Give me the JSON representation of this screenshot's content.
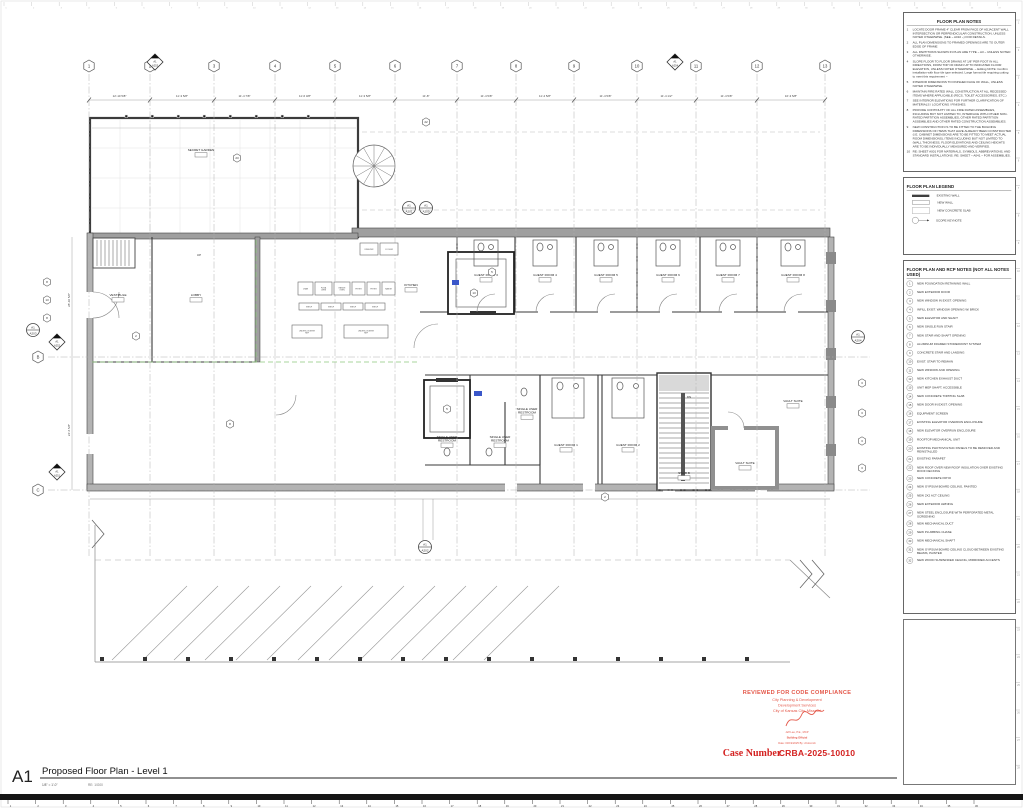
{
  "sheet": {
    "number": "A1",
    "title": "Proposed Floor Plan - Level 1",
    "scale": "1/8\" = 1'-0\"",
    "scale_ref": "RE: 1/G00"
  },
  "stamp": {
    "line1": "REVIEWED FOR CODE COMPLIANCE",
    "line2": "City Planning & Development",
    "line3": "Development Services",
    "line4": "City of Kansas City, Missouri",
    "signer": "Jeff Lee, P.E., MCP",
    "signer_title": "Building Official",
    "date_line": "Date: 03/19/2025    By: cholcomb",
    "case_label": "Case Number",
    "case_number": "CRBA-2025-10010"
  },
  "colors": {
    "stamp_red": "#e4584a",
    "case_red": "#d42221",
    "highlight_blue": "#3a57c9",
    "grid_gray": "#b0b0b0",
    "wall_dark": "#3c3c3c",
    "wall_gray": "#b3b3b3",
    "green_line": "#8fc97e"
  },
  "panels": {
    "notes": {
      "title": "FLOOR PLAN NOTES",
      "items": [
        "LOCATE DOOR FRAME 4\" CLEAR FROM FACE OF ADJACENT WALL INTERSECTION OR PERPENDICULAR CONSTRUCTION, UNLESS NOTED OTHERWISE. (SEE ~ A010 ~) FOR DETAILS.",
        "ALL PLAN DIMENSIONS TO FRAMED OPENINGS ARE TO OUTER EDGE OF FRAME",
        "ALL PARTITIONS SHOWN IN PLAN ARE TYPE ~ A3 ~ UNLESS NOTED OTHERWISE.",
        "SLOPE FLOOR TO FLOOR DRAINS AT 1/8\" PER FOOT IN ALL DIRECTIONS, FROM TOP OF DRAIN UP TO INDICATED FLOOR ELEVATION, UNLESS NOTED OTHERWISE. ~ Editing NOTE: Confirm installation with floor tile type selected. Large format tile requiring cutting to meet this requirement ~",
        "INTERIOR DIMENSIONS TO FINISHED FACE OF WALL, UNLESS NOTED OTHERWISE.",
        "MAINTAIN FIRE RATED WALL CONSTRUCTION AT ALL RECESSED ITEMS WHERE APPLICABLE (FECS, TOILET ACCESSORIES, ETC.)",
        "SEE INTERIOR ELEVATIONS FOR FURTHER CLARIFICATION OF MATERIALS / LOCATIONS / FINISHES.",
        "PROVIDE CONTINUITY OF ALL FIRE RATED ASSEMBLIES, INCLUDING BUT NOT LIMITED TO, INTERFACE WITH OTHER NON-RATED PARTITION ASSEMBLIES, OTHER RATED PARTITION ASSEMBLIES AND OTHER RATED CONSTRUCTION ASSEMBLIES.",
        "NEW CONSTRUCTION IS TO BE FITTED TO THE BUILDING DIMENSIONS OF ITEMS THAT HAVE ALREADY BEEN CONSTRUCTED (I.E. CABINET DIMENSIONS ARE TO BE FITTED TO MEET ACTUAL ROOM DIMENSIONS), ITEMS INCLUDING BUT NOT LIMITED TO (WALL THICKNESS, FLOOR ELEVATIONS AND CEILING HEIGHTS ARE TO BE INDIVIDUALLY MEASURED AND VERIFIED.",
        "RE: SHEET A001 FOR MATERIALS, SYMBOLS, ABBREVIATIONS, AND STANDARD INSTALLATIONS. RE: SHEET ~ A041 ~ FOR ASSEMBLIES."
      ]
    },
    "legend": {
      "title": "FLOOR PLAN LEGEND",
      "items": [
        {
          "symbol": "existing-wall",
          "label": "EXISTING WALL"
        },
        {
          "symbol": "new-wall",
          "label": "NEW WALL"
        },
        {
          "symbol": "new-concrete-slab",
          "label": "NEW CONCRETE SLAB"
        },
        {
          "symbol": "scope-keynote",
          "label": "SCOPE KEYNOTE"
        }
      ]
    },
    "refnotes": {
      "title": "FLOOR PLAN AND RCP NOTES (NOT ALL NOTES USED)",
      "items": [
        "NEW FOUNDATION RETAINING WALL",
        "NEW EXTERIOR DOOR",
        "NEW WINDOW IN EXIST. OPENING",
        "INFILL EXIST. WINDOW OPENING W/ BRICK",
        "NEW ELEVATOR AND SHAFT",
        "NEW SINGLE RUN STAIR",
        "NEW STAIR AND SHAFT OPENING",
        "ALUMINUM FRAMED STOREFRONT SYSTEM",
        "CONCRETE STAIR AND LANDING",
        "EXIST. STAIR TO REMAIN",
        "NEW WINDOW AND OPENING",
        "NEW KITCHEN EXHAUST DUCT",
        "UNIT MEP SHAFT, ACCESSIBLE",
        "NEW CONCRETE TOPPING SLAB",
        "NEW DOOR IN EXIST. OPENING",
        "EQUIPMENT SCREEN",
        "EXISTING ELEVATOR OVERRUN ENCLOSURE",
        "NEW ELEVATOR OVERRUN ENCLOSURE",
        "ROOFTOP MECHANICAL UNIT",
        "EXISTING PHOTOVOLTAIC PANELS TO BE REMOVED AND REINSTALLED",
        "EXISTING PARAPET",
        "NEW ROOF OVER NEW ROOF INSULATION OVER EXISTING ROOF DECKING",
        "NEW CONCRETE PATIO",
        "NEW GYPSUM BOARD CEILING, PAINTED",
        "NEW 2X2 ACT CEILING",
        "NEW EXTERIOR AWNING",
        "NEW STEEL ENCLOSURE WITH PERFORATED METAL SCREENING",
        "NEW MECHANICAL DUCT",
        "NEW PLUMBING CHASE",
        "NEW MECHANICAL SHAFT",
        "NEW GYPSUM BOARD CEILING CLOUD BETWEEN EXISTING BEAMS, PAINTED",
        "NEW WOOD SUSPENDED CEILING, MIRRORED ACCENTS"
      ]
    }
  },
  "plan": {
    "grid": {
      "columns": [
        {
          "label": "1",
          "x": 89
        },
        {
          "label": "2",
          "x": 150
        },
        {
          "label": "3",
          "x": 214
        },
        {
          "label": "4",
          "x": 275
        },
        {
          "label": "5",
          "x": 335
        },
        {
          "label": "6",
          "x": 395
        },
        {
          "label": "7",
          "x": 457
        },
        {
          "label": "8",
          "x": 516
        },
        {
          "label": "9",
          "x": 574
        },
        {
          "label": "10",
          "x": 637
        },
        {
          "label": "11",
          "x": 696
        },
        {
          "label": "12",
          "x": 757
        },
        {
          "label": "13",
          "x": 825
        }
      ],
      "rows": [
        {
          "label": "B",
          "y": 357
        },
        {
          "label": "C",
          "y": 490
        }
      ]
    },
    "dims_top": [
      "12'-10 5/8\"",
      "11'-3 5/8\"",
      "11'-4 7/8\"",
      "11'-6 3/8\"",
      "11'-3 5/8\"",
      "11'-8\"",
      "11'-4 5/8\"",
      "11'-4 5/8\"",
      "11'-4 5/8\"",
      "11'-4 1/2\"",
      "11'-4 5/8\"",
      "10'-3 5/8\""
    ],
    "dims_left": [
      "28'-10 5/8\"",
      "24'-6 5/8\""
    ],
    "rooms": [
      {
        "label": "SECRET GARDEN",
        "x": 201,
        "y": 151
      },
      {
        "label": "VESTIBULE",
        "x": 118,
        "y": 296
      },
      {
        "label": "LOBBY",
        "x": 196,
        "y": 296
      },
      {
        "label": "KITCHEN",
        "x": 411,
        "y": 286
      },
      {
        "label": "GUEST ROOM 3",
        "x": 486,
        "y": 276
      },
      {
        "label": "GUEST ROOM 4",
        "x": 545,
        "y": 276
      },
      {
        "label": "GUEST ROOM 5",
        "x": 606,
        "y": 276
      },
      {
        "label": "GUEST ROOM 6",
        "x": 668,
        "y": 276
      },
      {
        "label": "GUEST ROOM 7",
        "x": 728,
        "y": 276
      },
      {
        "label": "GUEST ROOM 8",
        "x": 793,
        "y": 276
      },
      {
        "label": "SINGLE USER RESTROOM",
        "x": 447,
        "y": 438
      },
      {
        "label": "SINGLE USER RESTROOM",
        "x": 500,
        "y": 438
      },
      {
        "label": "SINGLE USER RESTROOM",
        "x": 527,
        "y": 410
      },
      {
        "label": "GUEST ROOM 1",
        "x": 566,
        "y": 446
      },
      {
        "label": "GUEST ROOM 2",
        "x": 628,
        "y": 446
      },
      {
        "label": "VAULT SUITE",
        "x": 793,
        "y": 402
      },
      {
        "label": "VAULT SUITE",
        "x": 745,
        "y": 464
      },
      {
        "label": "STAIR B",
        "x": 684,
        "y": 474
      }
    ],
    "small_texts": [
      {
        "t": "UP",
        "x": 199,
        "y": 256
      },
      {
        "t": "DN",
        "x": 689,
        "y": 398
      }
    ],
    "equipment": [
      {
        "label": "CHAR",
        "x": 298,
        "y": 282,
        "w": 15,
        "h": 13
      },
      {
        "label": "PIZZA OVEN",
        "x": 315,
        "y": 282,
        "w": 17,
        "h": 13
      },
      {
        "label": "RANGE OVEN",
        "x": 334,
        "y": 282,
        "w": 16,
        "h": 13
      },
      {
        "label": "FRYER",
        "x": 352,
        "y": 282,
        "w": 13,
        "h": 13
      },
      {
        "label": "FRYER",
        "x": 367,
        "y": 282,
        "w": 13,
        "h": 13
      },
      {
        "label": "RANGE",
        "x": 382,
        "y": 282,
        "w": 13,
        "h": 13
      },
      {
        "label": "SHELF",
        "x": 299,
        "y": 303,
        "w": 20,
        "h": 7
      },
      {
        "label": "SHELF",
        "x": 321,
        "y": 303,
        "w": 20,
        "h": 7
      },
      {
        "label": "SHELF",
        "x": 343,
        "y": 303,
        "w": 20,
        "h": 7
      },
      {
        "label": "SHELF",
        "x": 365,
        "y": 303,
        "w": 20,
        "h": 7
      },
      {
        "label": "UNDERCOUNTER REF",
        "x": 292,
        "y": 325,
        "w": 30,
        "h": 13
      },
      {
        "label": "UNDERCOUNTER REF",
        "x": 344,
        "y": 325,
        "w": 44,
        "h": 13
      },
      {
        "label": "FREEZER",
        "x": 360,
        "y": 243,
        "w": 18,
        "h": 12
      },
      {
        "label": "COOLER",
        "x": 380,
        "y": 243,
        "w": 18,
        "h": 12
      }
    ],
    "keynotes": [
      {
        "n": "23",
        "x": 237,
        "y": 158
      },
      {
        "n": "22",
        "x": 426,
        "y": 122
      },
      {
        "n": "8",
        "x": 47,
        "y": 282
      },
      {
        "n": "13",
        "x": 47,
        "y": 300
      },
      {
        "n": "8",
        "x": 47,
        "y": 318
      },
      {
        "n": "2",
        "x": 136,
        "y": 336
      },
      {
        "n": "8",
        "x": 230,
        "y": 424
      },
      {
        "n": "5",
        "x": 492,
        "y": 272
      },
      {
        "n": "5",
        "x": 447,
        "y": 409
      },
      {
        "n": "13",
        "x": 474,
        "y": 293
      },
      {
        "n": "3",
        "x": 862,
        "y": 383
      },
      {
        "n": "3",
        "x": 862,
        "y": 413
      },
      {
        "n": "3",
        "x": 862,
        "y": 441
      },
      {
        "n": "3",
        "x": 862,
        "y": 468
      },
      {
        "n": "2",
        "x": 605,
        "y": 497
      }
    ],
    "markers": {
      "circles": [
        {
          "top": "A1",
          "bottom": "A203",
          "x": 33,
          "y": 330
        },
        {
          "top": "A1",
          "bottom": "A204",
          "x": 858,
          "y": 337
        },
        {
          "top": "A1",
          "bottom": "A201",
          "x": 409,
          "y": 208
        },
        {
          "top": "A1",
          "bottom": "A200",
          "x": 426,
          "y": 208
        },
        {
          "top": "A1",
          "bottom": "A202",
          "x": 425,
          "y": 547
        }
      ],
      "diamonds": [
        {
          "top": "A1",
          "bottom": "A253",
          "x": 155,
          "y": 62
        },
        {
          "top": "A1",
          "bottom": "A254",
          "x": 675,
          "y": 62
        },
        {
          "top": "A1",
          "bottom": "A252",
          "x": 57,
          "y": 342
        },
        {
          "top": "A1",
          "bottom": "A251",
          "x": 57,
          "y": 472
        }
      ]
    },
    "highlights": [
      {
        "x": 452,
        "y": 280,
        "w": 7,
        "h": 5
      },
      {
        "x": 474,
        "y": 391,
        "w": 8,
        "h": 5
      }
    ]
  },
  "rulers": {
    "bottom_count": 36,
    "right_count": 28,
    "top_count": 37
  }
}
